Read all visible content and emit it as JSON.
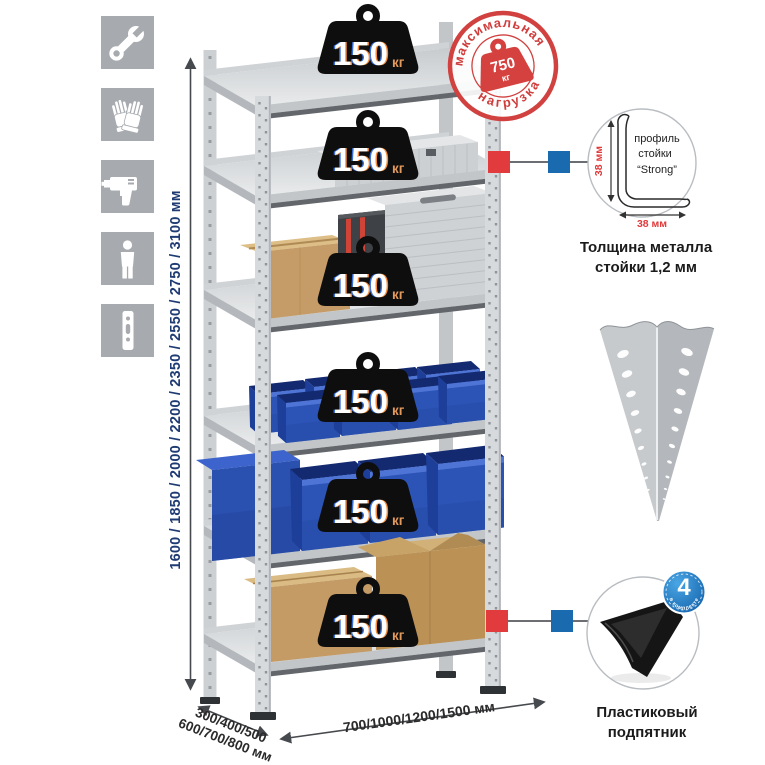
{
  "icons_panel": {
    "items": [
      {
        "icon": "wrench-icon"
      },
      {
        "icon": "gloves-icon"
      },
      {
        "icon": "drill-icon"
      },
      {
        "icon": "person-icon"
      },
      {
        "icon": "post-profile-icon"
      }
    ]
  },
  "dimensions": {
    "height_label": "1600 / 1850 / 2000 / 2200 / 2350 / 2550 / 2750 / 3100 мм",
    "depth_line1": "300/400/500",
    "depth_line2": "600/700/800 мм",
    "width_label": "700/1000/1200/1500 мм"
  },
  "shelf_weights": {
    "value": "150",
    "unit": "кг"
  },
  "max_load_stamp": {
    "arc_top": "максимальная",
    "arc_bottom": "нагрузка",
    "value": "750",
    "unit": "кг"
  },
  "profile_detail": {
    "label_line1": "профиль",
    "label_line2": "стойки",
    "label_line3": "“Strong”",
    "dim_height": "38 мм",
    "dim_width": "38 мм",
    "caption_line1": "Толщина металла",
    "caption_line2": "стойки 1,2 мм"
  },
  "foot_detail": {
    "badge_number": "4",
    "badge_arc": "в комплекте",
    "caption_line1": "Пластиковый",
    "caption_line2": "подпятник"
  },
  "colors": {
    "panel_gray": "#a7abaf",
    "metal_gray": "#d7dadd",
    "bin_blue": "#2c54b6",
    "cardboard": "#c49a65",
    "stamp_red": "#cf3e3d",
    "marker_red": "#e23b3d",
    "marker_blue": "#1a6ab0",
    "height_text_blue": "#1f3b73",
    "weight_black": "#0e0e0e"
  }
}
